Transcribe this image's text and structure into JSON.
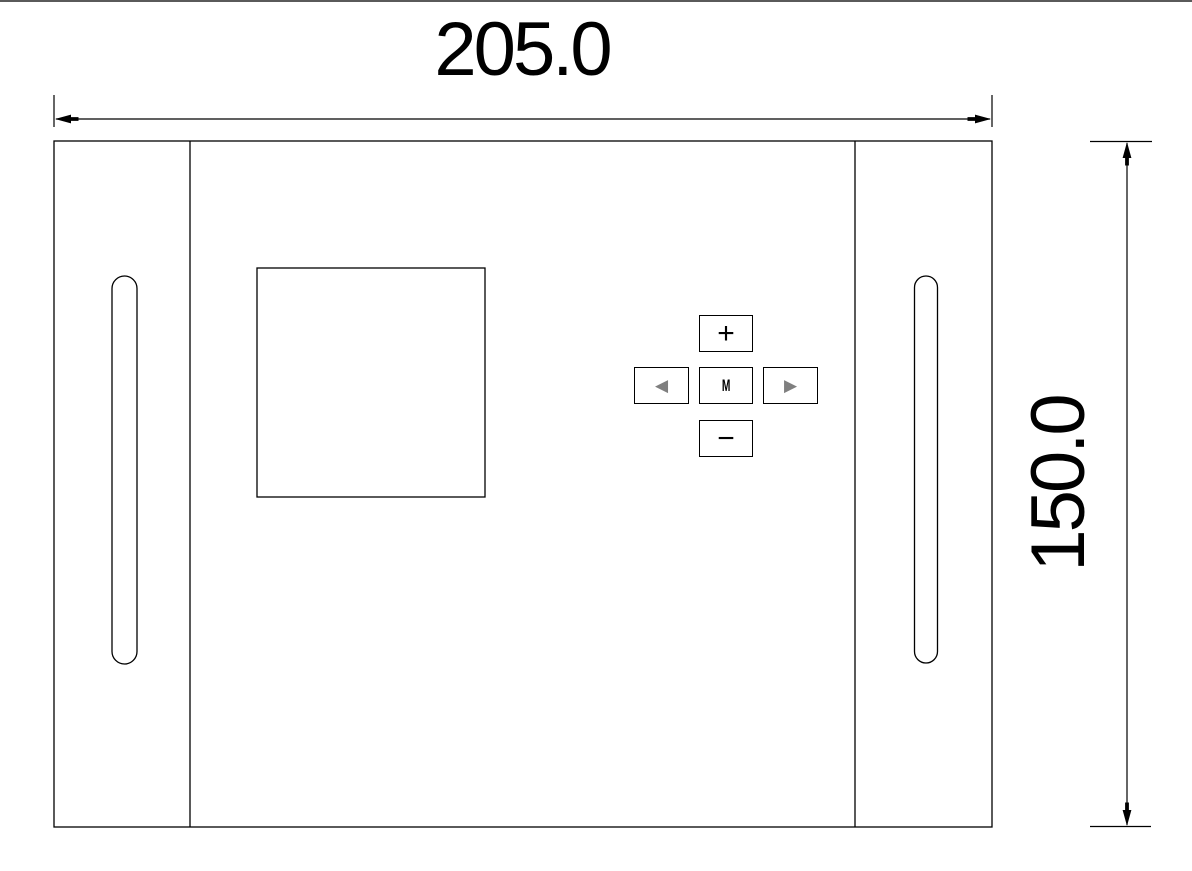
{
  "dimensions": {
    "width_label": "205.0",
    "height_label": "150.0"
  },
  "keypad": {
    "plus_label": "+",
    "minus_label": "−",
    "menu_label": "M",
    "left_icon": "◀",
    "right_icon": "▶"
  },
  "colors": {
    "line": "#000000",
    "keypad_arrow_gray": "#7f7f7f",
    "top_edge_gray": "#5a5a5a",
    "background": "#ffffff"
  }
}
